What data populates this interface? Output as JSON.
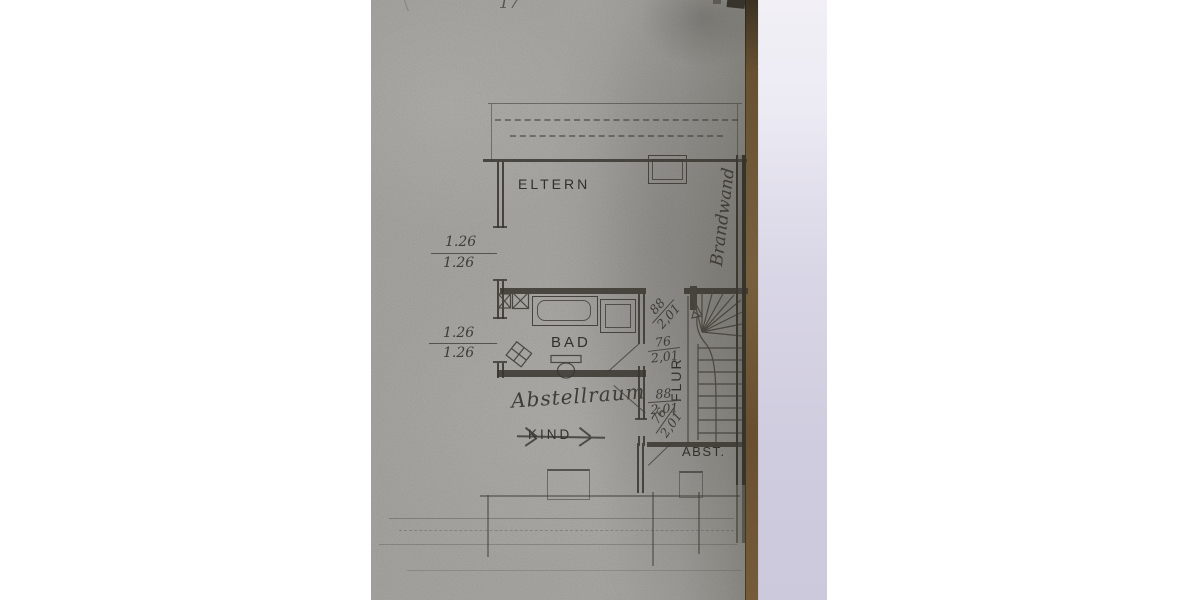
{
  "photo": {
    "alt": "Photograph of an old architectural floor plan (upper storey)",
    "page_background": "#ffffff",
    "paper_color": "#a7a6a2",
    "edge_binding_color": "#6d5535",
    "backing_surface_color": "#d9d6e5",
    "ink_color": "#45433c"
  },
  "labels": {
    "eltern": "ELTERN",
    "bad": "BAD",
    "flur": "FLUR",
    "kind": "KIND",
    "abst": "ABST."
  },
  "handwriting": {
    "top_mark": "17",
    "abstellraum": "Abstellraum",
    "brandwand": "Brandwand"
  },
  "dimensions": {
    "window_upper": {
      "top": "1.26",
      "bottom": "1.26"
    },
    "window_lower": {
      "top": "1.26",
      "bottom": "1.26"
    },
    "door_hall_top": {
      "top": "88",
      "bottom": "2,01"
    },
    "door_bad": {
      "top": "76",
      "bottom": "2,01"
    },
    "door_abstellraum": {
      "top": "88",
      "bottom": "2,01"
    },
    "door_abst": {
      "top": "76",
      "bottom": "2,01"
    }
  }
}
